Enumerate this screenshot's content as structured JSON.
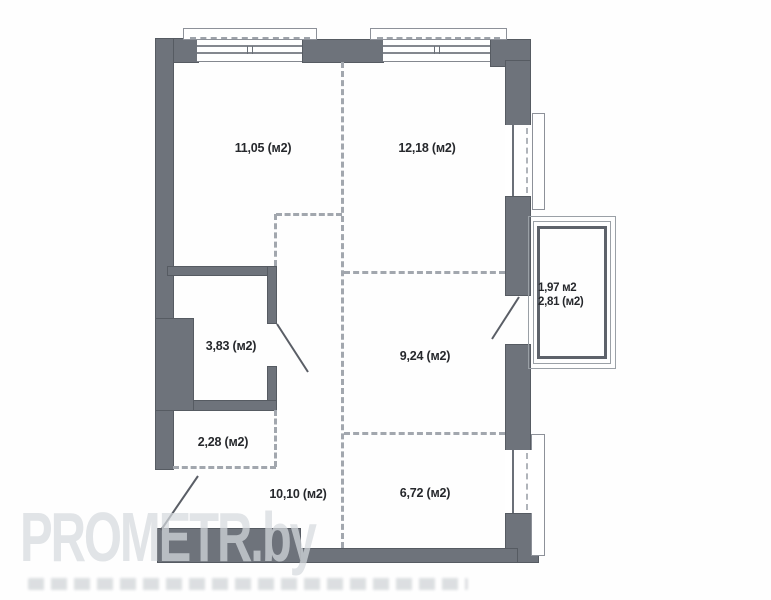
{
  "plan": {
    "rooms": [
      {
        "name": "room-top-left",
        "label": "11,05 (м2)",
        "area_m2": 11.05
      },
      {
        "name": "room-top-right",
        "label": "12,18 (м2)",
        "area_m2": 12.18
      },
      {
        "name": "bathroom",
        "label": "3,83 (м2)",
        "area_m2": 3.83
      },
      {
        "name": "room-middle-right",
        "label": "9,24 (м2)",
        "area_m2": 9.24
      },
      {
        "name": "closet",
        "label": "2,28 (м2)",
        "area_m2": 2.28
      },
      {
        "name": "hallway",
        "label": "10,10 (м2)",
        "area_m2": 10.1
      },
      {
        "name": "room-bottom-right",
        "label": "6,72 (м2)",
        "area_m2": 6.72
      }
    ],
    "balcony": {
      "label_line1": "1,97 м2",
      "label_line2": "2,81 (м2)",
      "area_m2_reduced": 1.97,
      "area_m2_full": 2.81
    }
  },
  "watermark": {
    "brand": "PROMETR.by"
  },
  "colors": {
    "wall": "#6e737b",
    "wallborder": "#565b62",
    "dash": "#a2a7ae",
    "line": "#8d9199",
    "text": "#26282c"
  }
}
